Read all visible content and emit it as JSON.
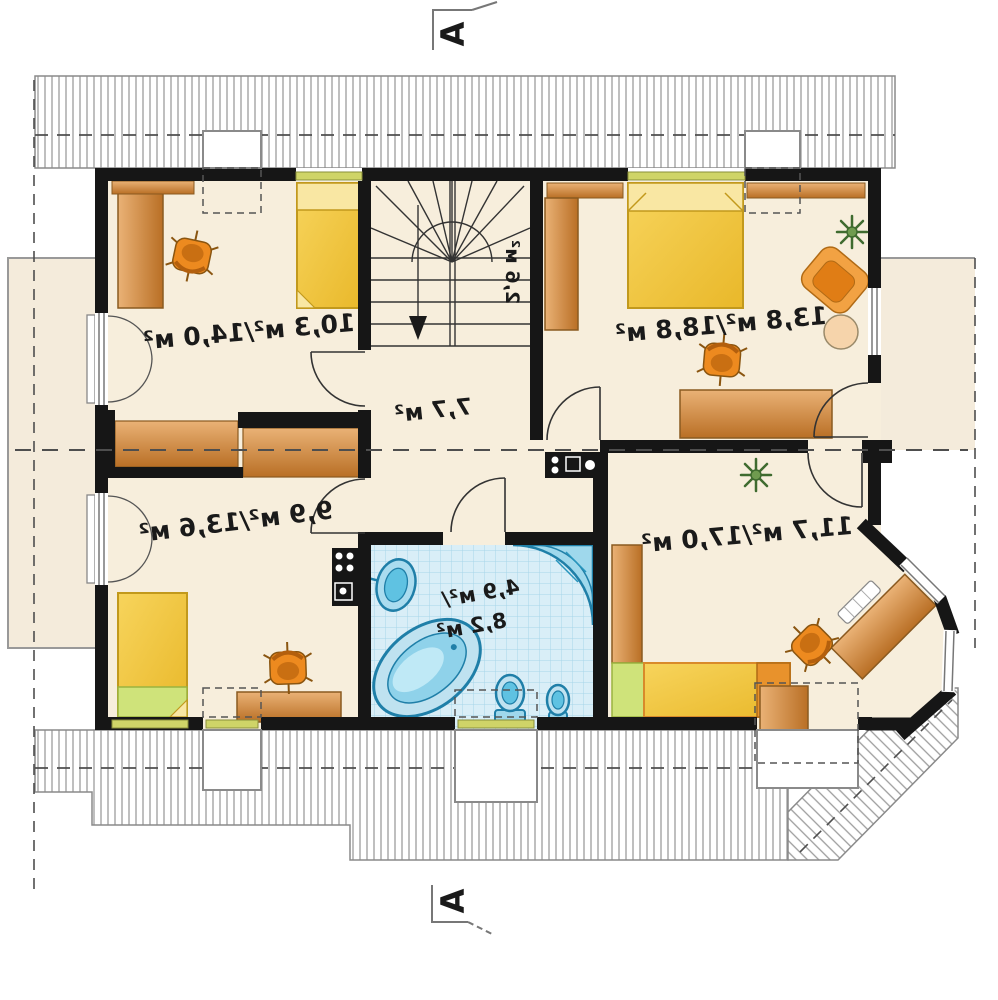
{
  "plan": {
    "type": "attic-floor-plan",
    "orientation": "mirrored-text",
    "section_marker_top": "A",
    "section_marker_bottom": "A",
    "rooms": {
      "room_top_left": {
        "name": "bedroom-top-left",
        "area_label": "10,3 м²/14,0 м²"
      },
      "room_top_right": {
        "name": "bedroom-top-right",
        "area_label": "13,8 м²/18,8 м²"
      },
      "room_bottom_left": {
        "name": "bedroom-bottom-left",
        "area_label": "9,9 м²/13,6 м²"
      },
      "room_bottom_right": {
        "name": "bedroom-bottom-right",
        "area_label": "11,7 м²/17,0 м²"
      },
      "hall": {
        "name": "hall",
        "area_label": "7,7 м²"
      },
      "stairs": {
        "name": "staircase",
        "area_label": "2,6 м²"
      },
      "bathroom": {
        "name": "bathroom",
        "area_label_line1": "4,9 м²/",
        "area_label_line2": "8,2 м²"
      }
    },
    "colors": {
      "wall": "#161616",
      "floor": "#f7eedc",
      "roof_hatch_line": "#9d9d9d",
      "roof_outline": "#8a8a8a",
      "dash_line": "#4e4e4e",
      "wood_light": "#eab276",
      "wood_dark": "#b96f25",
      "bed_yellow": "#f2c73e",
      "bed_yellow_light": "#f9e7a3",
      "bed_green": "#cfe37a",
      "chair_orange": "#ed8a1f",
      "tile_base": "#d9eef7",
      "tile_line": "#a8d5e8",
      "fixture_blue": "#5fc2e2",
      "fixture_stroke": "#1f7fa8",
      "window_green": "#cfd468"
    }
  }
}
